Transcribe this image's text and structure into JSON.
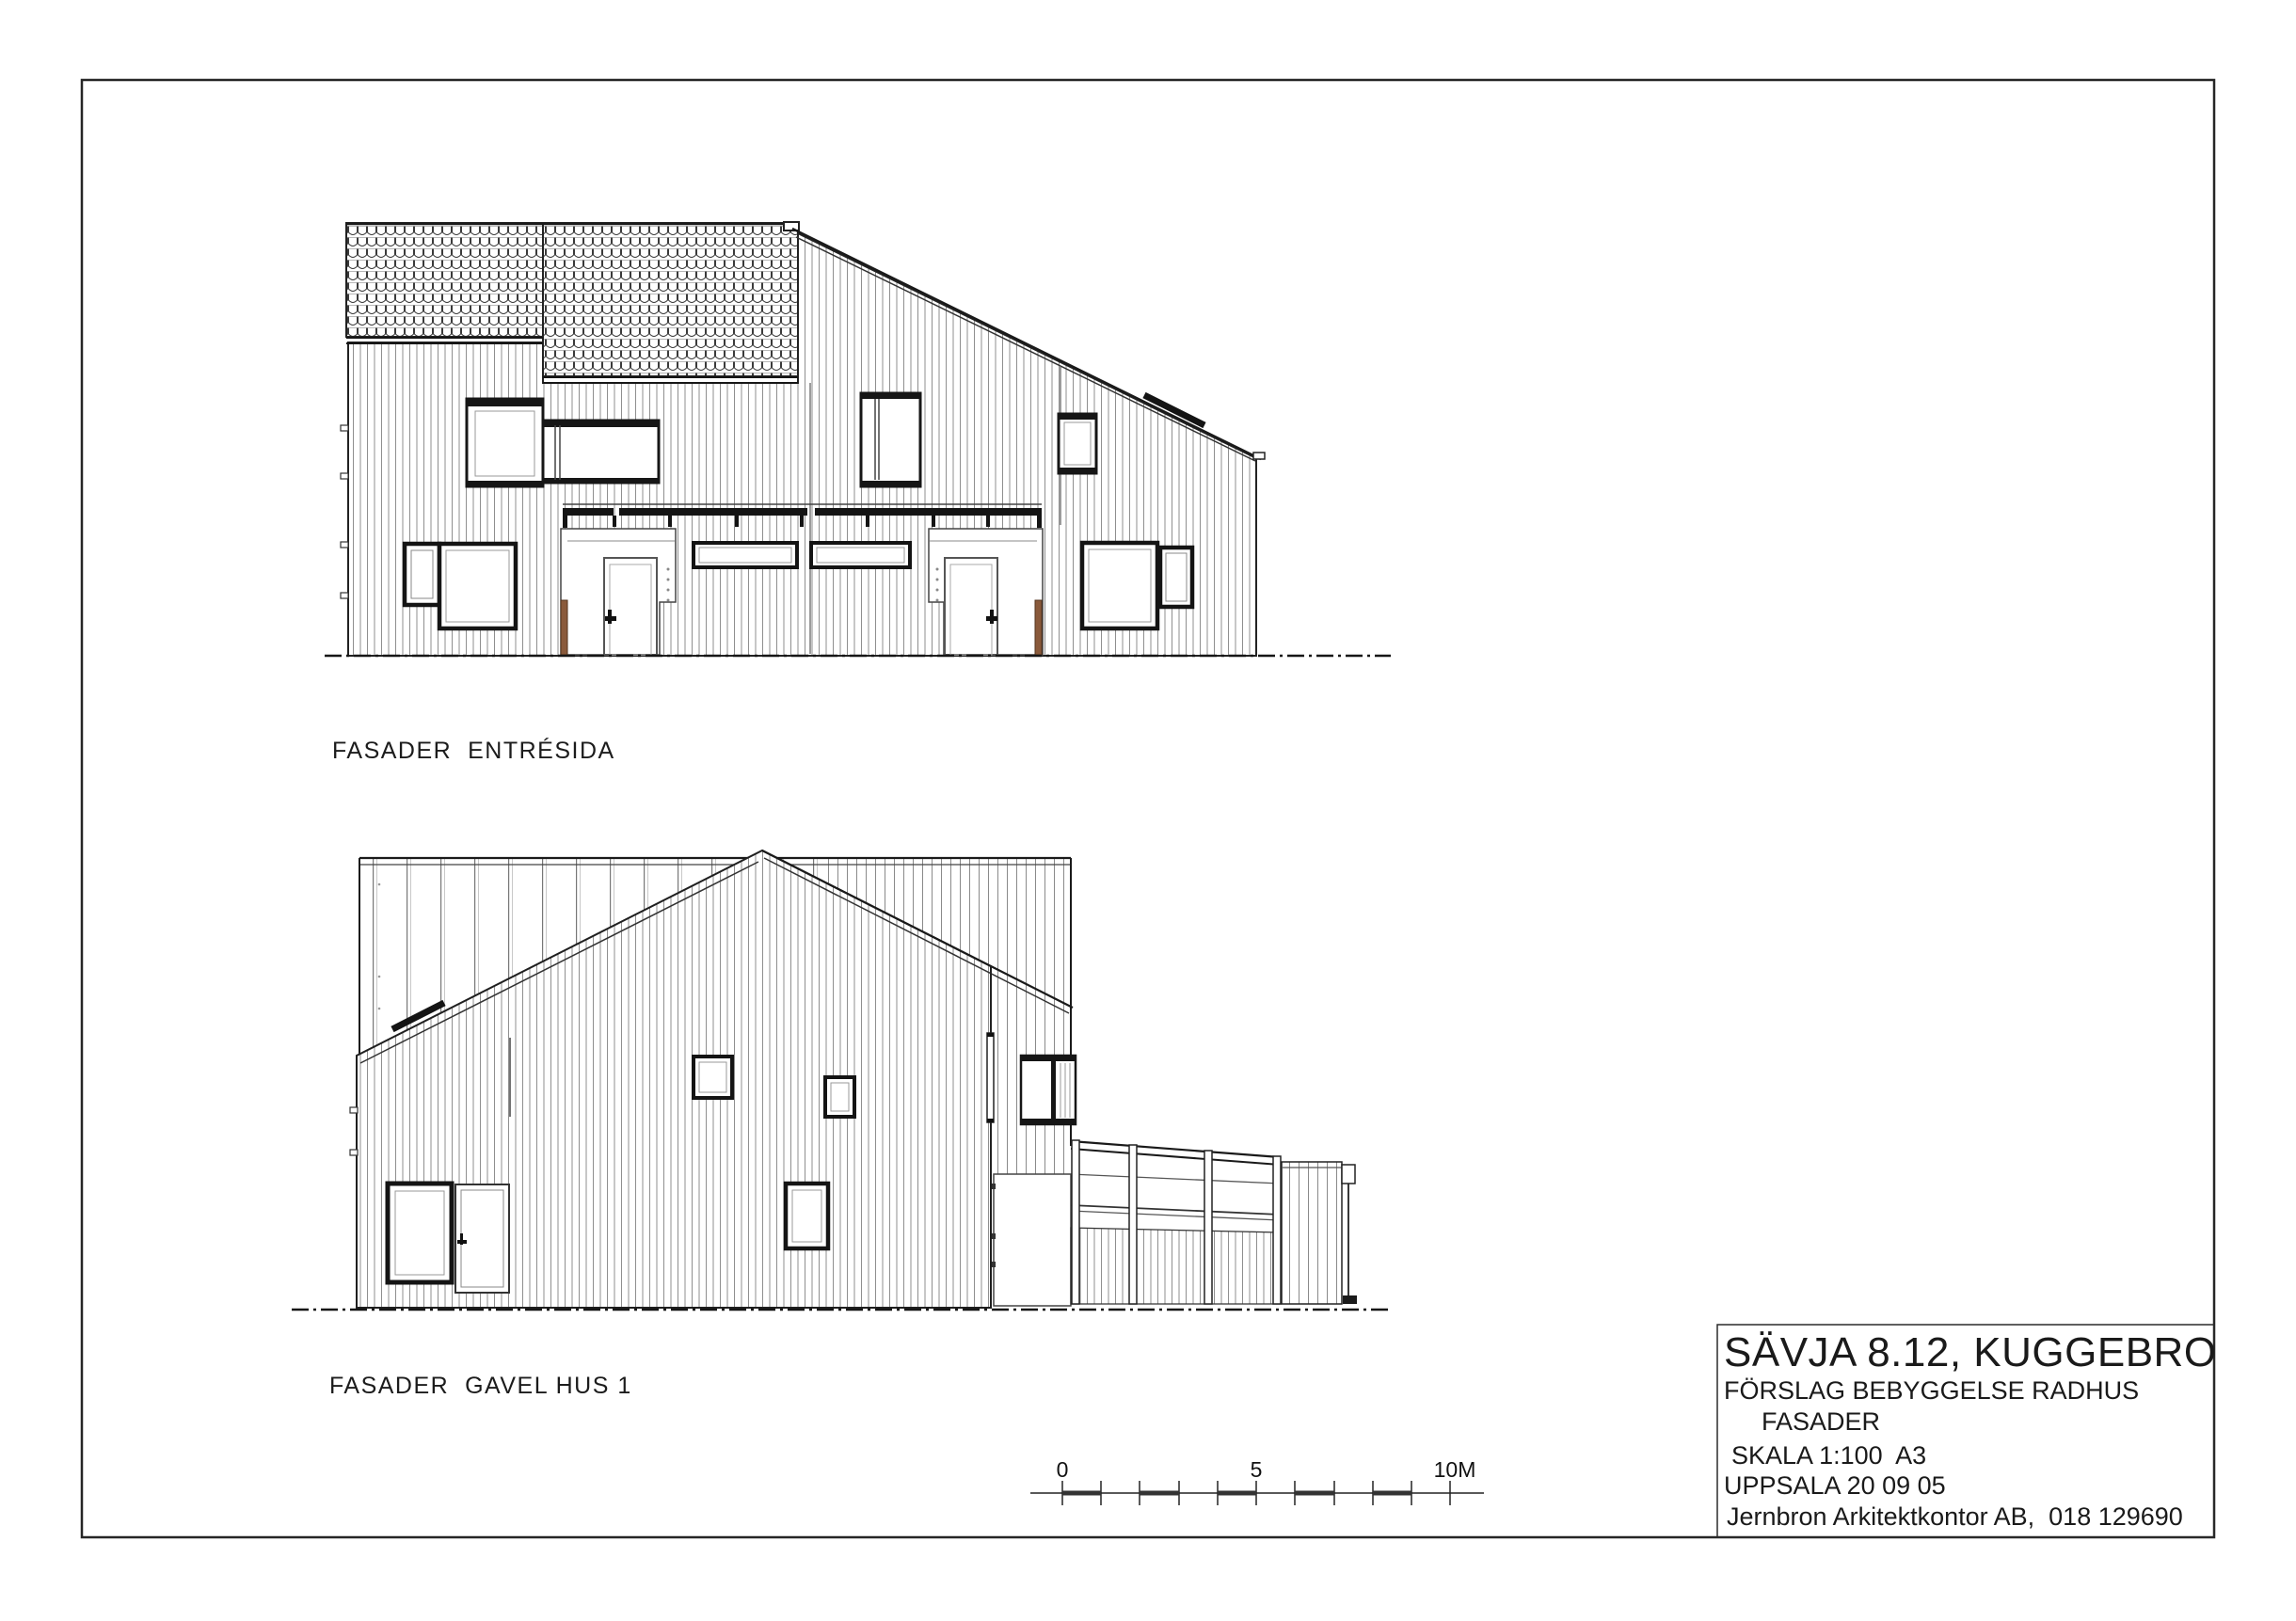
{
  "sheet": {
    "labels": {
      "elevation1": "FASADER  ENTRÉSIDA",
      "elevation2": "FASADER  GAVEL HUS 1"
    },
    "title_block": {
      "project": "SÄVJA 8.12, KUGGEBRO",
      "subtitle": "FÖRSLAG BEBYGGELSE RADHUS",
      "drawing_type": "FASADER",
      "scale": "SKALA 1:100  A3",
      "place_date": "UPPSALA 20 09 05",
      "firm": "Jernbron Arkitektkontor AB,  018 129690"
    },
    "scale_bar": {
      "start_label": "0",
      "mid_label": "5",
      "end_label": "10M",
      "units": "meters",
      "divisions": 10
    },
    "colors": {
      "line": "#1a1a1a",
      "siding_line": "#8f8f8f",
      "wood_post": "#8a5a3b",
      "paper": "#ffffff"
    }
  }
}
